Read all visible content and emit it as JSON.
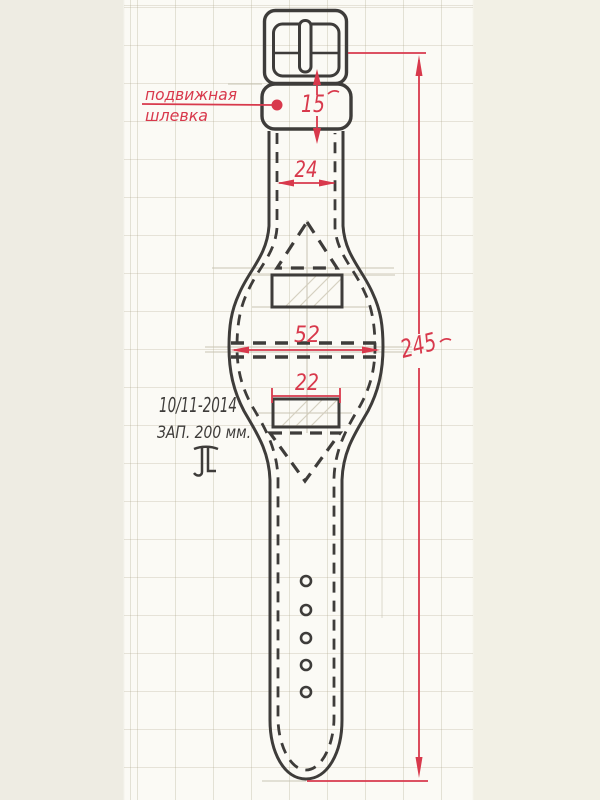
{
  "annotations": {
    "keeper_label_line1": "подвижная",
    "keeper_label_line2": "шлевка",
    "dim_keeper_height": "15",
    "dim_strap_width": "24",
    "dim_cuff_width": "52",
    "dim_slot_width": "22",
    "dim_total_length": "245",
    "date": "10/11-2014",
    "length_note": "ЗАП. 200 мм.",
    "monogram": "ЛТ"
  },
  "figure": {
    "punch_holes": 5
  },
  "colors": {
    "ink": "#3e3c3a",
    "red": "#d8394c",
    "pencil": "#c6c1b0",
    "paper_center": "#fbfaf5",
    "paper_left_margin": "#eeece3",
    "paper_right_margin": "#f2f0e5"
  }
}
